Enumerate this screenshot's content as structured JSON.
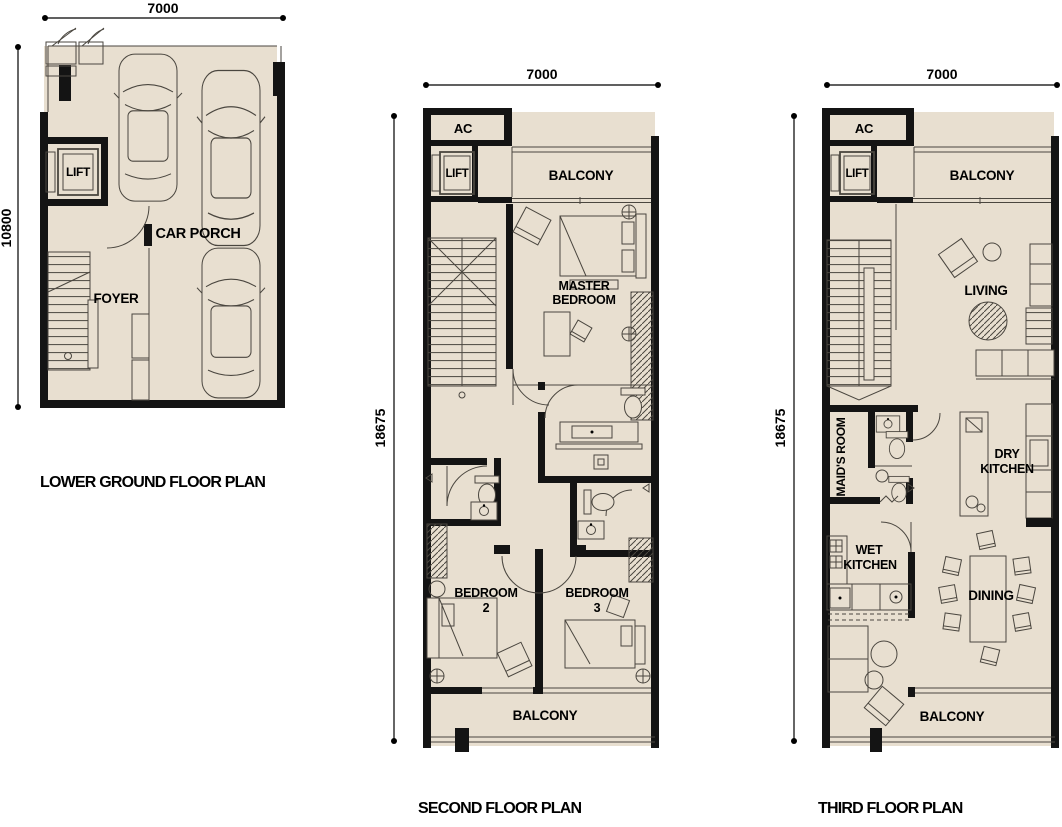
{
  "colors": {
    "bg": "#ffffff",
    "floor": "#e8dfd0",
    "wall": "#141414",
    "line": "#4a463f",
    "text": "#000000"
  },
  "plans": [
    {
      "caption": "LOWER GROUND FLOOR PLAN",
      "dim_width": "7000",
      "dim_height": "10800",
      "labels": {
        "lift": "LIFT",
        "car_porch": "CAR PORCH",
        "foyer": "FOYER"
      }
    },
    {
      "caption": "SECOND FLOOR PLAN",
      "dim_width": "7000",
      "dim_height": "18675",
      "labels": {
        "ac": "AC",
        "lift": "LIFT",
        "balcony_top": "BALCONY",
        "master_1": "MASTER",
        "master_2": "BEDROOM",
        "bedroom2_1": "BEDROOM",
        "bedroom2_2": "2",
        "bedroom3_1": "BEDROOM",
        "bedroom3_2": "3",
        "balcony_bottom": "BALCONY"
      }
    },
    {
      "caption": "THIRD FLOOR PLAN",
      "dim_width": "7000",
      "dim_height": "18675",
      "labels": {
        "ac": "AC",
        "lift": "LIFT",
        "balcony_top": "BALCONY",
        "living": "LIVING",
        "maids_room": "MAID'S ROOM",
        "dry_1": "DRY",
        "dry_2": "KITCHEN",
        "wet_1": "WET",
        "wet_2": "KITCHEN",
        "dining": "DINING",
        "balcony_bottom": "BALCONY"
      }
    }
  ]
}
